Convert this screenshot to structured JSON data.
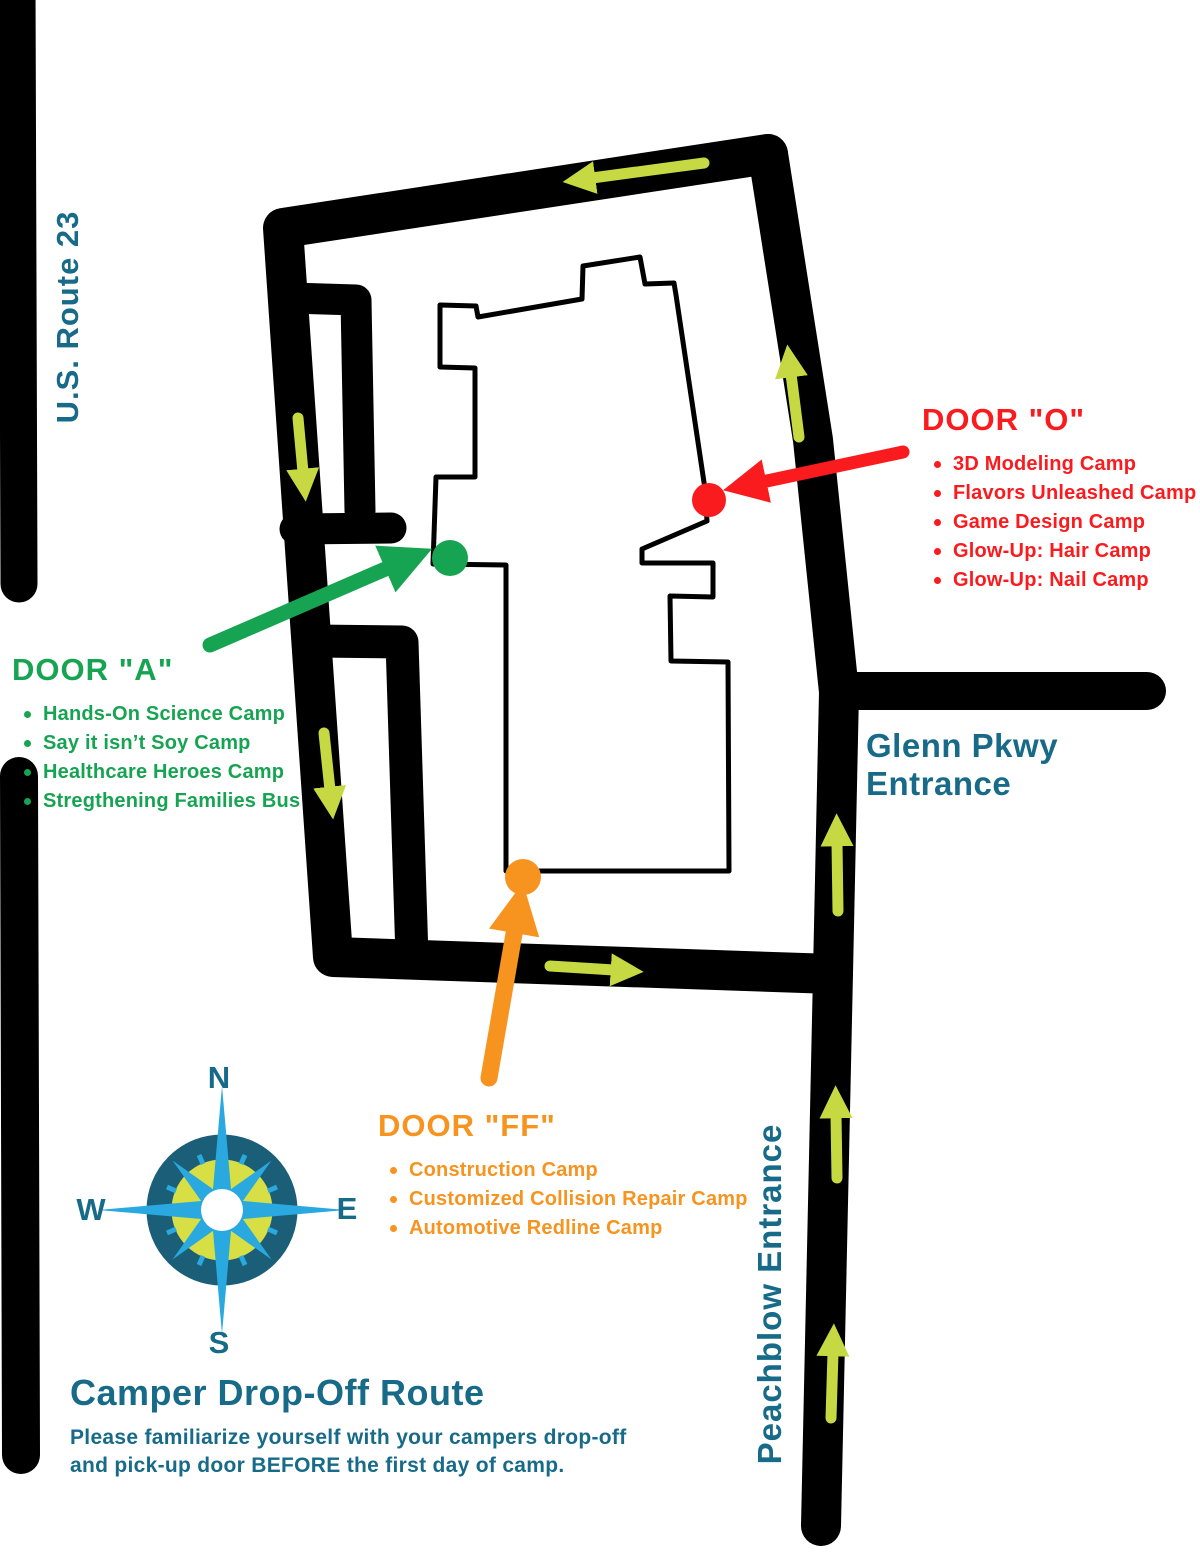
{
  "labels": {
    "us_route": "U.S. Route 23",
    "glenn_line1": "Glenn Pkwy",
    "glenn_line2": "Entrance",
    "peachblow": "Peachblow Entrance"
  },
  "compass": {
    "north": "N",
    "south": "S",
    "east": "E",
    "west": "W"
  },
  "doors": {
    "a": {
      "title": "DOOR \"A\"",
      "camps": [
        "Hands-On Science Camp",
        "Say it isn’t Soy Camp",
        "Healthcare Heroes Camp",
        "Stregthening Families Bus"
      ]
    },
    "o": {
      "title": "DOOR \"O\"",
      "camps": [
        "3D Modeling Camp",
        "Flavors Unleashed Camp",
        "Game Design Camp",
        "Glow-Up: Hair Camp",
        "Glow-Up: Nail Camp"
      ]
    },
    "ff": {
      "title": "DOOR \"FF\"",
      "camps": [
        "Construction Camp",
        "Customized Collision Repair Camp",
        "Automotive Redline Camp"
      ]
    }
  },
  "footer": {
    "title": "Camper Drop-Off Route",
    "line1": "Please familiarize yourself with your campers drop-off",
    "line2": "and pick-up door BEFORE the first day of camp."
  },
  "colors": {
    "teal_text": "#176b88",
    "door_a_green": "#17a452",
    "door_o_red": "#fa1b1f",
    "door_ff_orange": "#f79420",
    "route_arrow_yellow": "#c6d942",
    "road_black": "#000000",
    "compass_blue": "#29a9e0",
    "compass_ring_teal": "#1b5e78",
    "compass_inner_yellow": "#d7df45"
  }
}
